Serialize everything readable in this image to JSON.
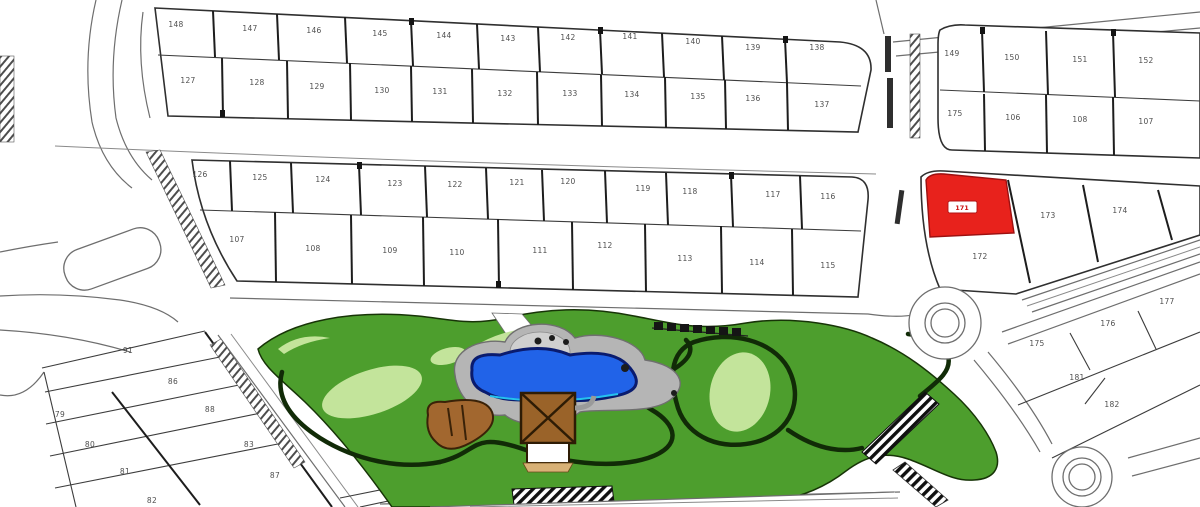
{
  "colors": {
    "highlight_red": "#e8221c",
    "park_green": "#4d9e2d",
    "fairway_light_green": "#c3e49b",
    "pool_blue": "#2163e8",
    "pool_edge": "#0a1b6e",
    "deck_gray": "#b5b5b5",
    "deck_inner_gray": "#cfcfcf",
    "building_brown": "#9a6329",
    "log_brown": "#a2672f",
    "patio_white": "#ffffff"
  },
  "highlighted_lot": {
    "number": "171"
  },
  "lots": {
    "row_a1": [
      "148",
      "147",
      "146",
      "145",
      "144",
      "143",
      "142",
      "141",
      "140",
      "139",
      "138"
    ],
    "row_a2": [
      "127",
      "128",
      "129",
      "130",
      "131",
      "132",
      "133",
      "134",
      "135",
      "136",
      "137"
    ],
    "row_b1": [
      "126",
      "125",
      "124",
      "123",
      "122",
      "121",
      "120",
      "119",
      "118",
      "117",
      "116"
    ],
    "row_b2": [
      "107",
      "108",
      "109",
      "110",
      "111",
      "112",
      "113",
      "114",
      "115"
    ],
    "row_c1": [
      "149",
      "150",
      "151",
      "152"
    ],
    "row_c2": [
      "175",
      "106",
      "108",
      "107"
    ],
    "east": [
      "172",
      "173",
      "174"
    ],
    "se": [
      "177",
      "176",
      "175",
      "181",
      "182"
    ],
    "sw_left": [
      "79",
      "80",
      "81",
      "82"
    ],
    "sw_right": [
      "91",
      "86",
      "88",
      "83",
      "87"
    ]
  }
}
